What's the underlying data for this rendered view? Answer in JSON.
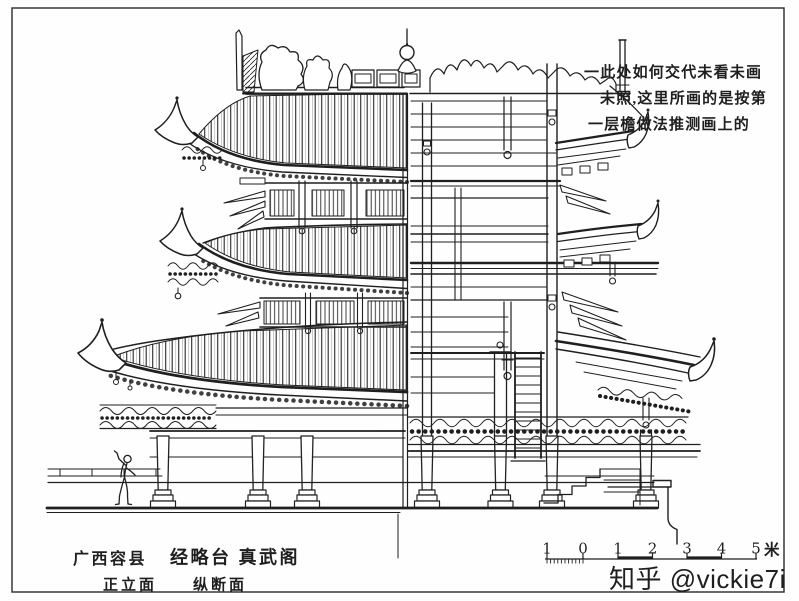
{
  "colors": {
    "ink": "#1f1f1f",
    "paper": "#fefefe",
    "watermark": "#c5c5c5"
  },
  "annotation": {
    "line1": "一此处如何交代未看未画",
    "line2": "未照,这里所画的是按第",
    "line3": "一层檐做法推测画上的"
  },
  "titles": {
    "location": "广西容县",
    "building": "经略台 真武阁",
    "view_left": "正立面",
    "view_right": "纵断面"
  },
  "scale_bar": {
    "labels": [
      "1",
      "0",
      "1",
      "2",
      "3",
      "4",
      "5"
    ],
    "unit": "米"
  },
  "watermark": {
    "text": "知乎 @vickie7i"
  }
}
